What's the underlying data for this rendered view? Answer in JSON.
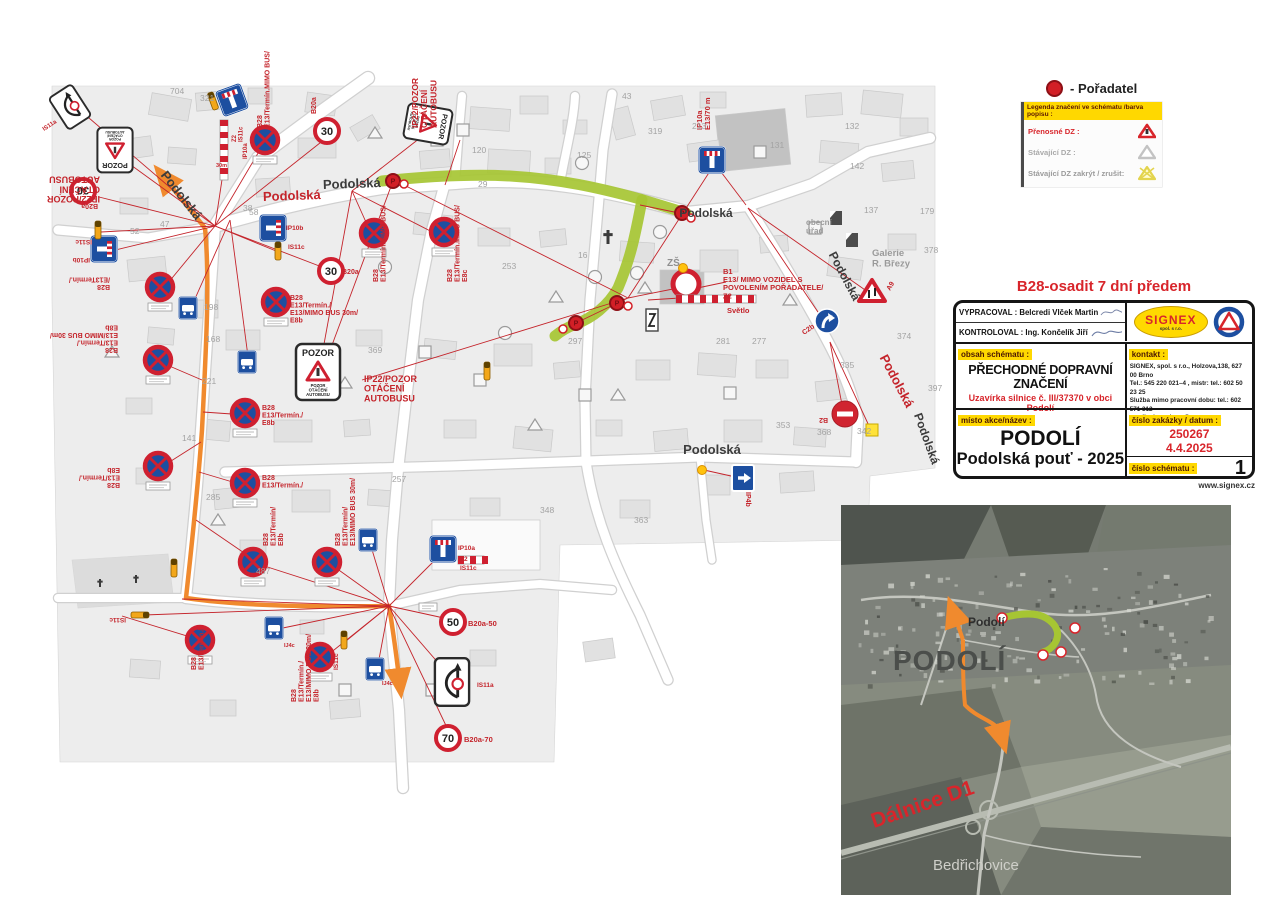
{
  "legend": {
    "poradatel_label": "- Pořadatel",
    "header": "Legenda značení ve schématu /barva popisu :",
    "rows": [
      {
        "label": "Přenosné  DZ :",
        "style": "red"
      },
      {
        "label": "Stávající DZ :",
        "style": "gray"
      },
      {
        "label": "Stávající DZ zakrýt / zrušit:",
        "style": "gray2"
      }
    ]
  },
  "title_block": {
    "heading": "B28-osadit 7 dní předem",
    "vypracoval_label": "VYPRACOVAL",
    "vypracoval_value": ": Belcredi Vlček Martin",
    "kontroloval_label": "KONTROLOVAL",
    "kontroloval_value": ": Ing. Končelík Jiří",
    "logo_text": "SIGNEX",
    "logo_sub": "spol. s r.o.",
    "obsah_label": "obsah schématu :",
    "obsah_title": "PŘECHODNÉ DOPRAVNÍ ZNAČENÍ",
    "obsah_sub": "Uzavírka silnice č. III/37370 v obci Podolí",
    "kontakt_label": "kontakt :",
    "kontakt_lines": [
      "SIGNEX, spol. s r.o., Holzova,138, 627 00 Brno",
      "Tel.: 545 220 021–4 , mistr: tel.: 602 50 23 25",
      "Služba mimo pracovní dobu: tel.: 602 571 312",
      "email: signexbrno@seznam.cz"
    ],
    "misto_label": "místo  akce/název :",
    "misto_line1": "PODOLÍ",
    "misto_line2": "Podolská pouť - 2025",
    "zakazka_label": "číslo zakázky / datum :",
    "zakazka_cislo": "250267",
    "zakazka_datum": "4.4.2025",
    "schema_label": "číslo schématu :",
    "schema_cislo": "1",
    "website": "www.signex.cz"
  },
  "inset": {
    "town_big": "PODOLÍ",
    "town_small": "Podolí",
    "highway": "Dálnice D1",
    "village": "Bedřichovice"
  },
  "colors": {
    "red": "#c4242b",
    "green_route": "#a6c533",
    "orange_route": "#f08a2e",
    "sign_blue": "#1d4fa0",
    "sign_red": "#cf2030",
    "yellow": "#ffd800"
  },
  "map": {
    "street_labels": [
      [
        "Podolská",
        178,
        198,
        52,
        "#3c3c3c",
        13
      ],
      [
        "Podolská",
        292,
        200,
        -2,
        "#c4242b",
        13
      ],
      [
        "Podolská",
        352,
        188,
        -2,
        "#3c3c3c",
        13
      ],
      [
        "Podolská",
        706,
        217,
        0,
        "#3c3c3c",
        12
      ],
      [
        "Podolská",
        841,
        278,
        62,
        "#3c3c3c",
        12
      ],
      [
        "Podolská",
        893,
        383,
        62,
        "#c4242b",
        13
      ],
      [
        "Podolská",
        923,
        440,
        70,
        "#3c3c3c",
        12
      ],
      [
        "Podolská",
        712,
        454,
        0,
        "#3c3c3c",
        13
      ]
    ],
    "gray_labels": [
      [
        "ZŠ",
        667,
        266,
        10,
        "#8f8f8f"
      ],
      [
        "obecní|úřad",
        806,
        225,
        8,
        "#9a9a9a"
      ],
      [
        "Galerie|R. Březy",
        872,
        256,
        9.5,
        "#9a9a9a"
      ]
    ],
    "numbers": [
      [
        "704",
        170,
        94
      ],
      [
        "321",
        200,
        101
      ],
      [
        "43",
        622,
        99
      ],
      [
        "319",
        648,
        134
      ],
      [
        "213",
        692,
        129
      ],
      [
        "120",
        472,
        153
      ],
      [
        "125",
        577,
        158
      ],
      [
        "131",
        770,
        148
      ],
      [
        "132",
        845,
        129
      ],
      [
        "142",
        850,
        169
      ],
      [
        "137",
        864,
        213
      ],
      [
        "179",
        920,
        214
      ],
      [
        "378",
        924,
        253
      ],
      [
        "374",
        897,
        339
      ],
      [
        "397",
        928,
        391
      ],
      [
        "335",
        840,
        368
      ],
      [
        "353",
        776,
        428
      ],
      [
        "368",
        817,
        435
      ],
      [
        "342",
        857,
        434
      ],
      [
        "281",
        716,
        344
      ],
      [
        "277",
        752,
        344
      ],
      [
        "297",
        568,
        344
      ],
      [
        "253",
        502,
        269
      ],
      [
        "369",
        368,
        353
      ],
      [
        "168",
        206,
        342
      ],
      [
        "198",
        204,
        310
      ],
      [
        "221",
        202,
        384
      ],
      [
        "141",
        182,
        441
      ],
      [
        "285",
        206,
        500
      ],
      [
        "47",
        160,
        227
      ],
      [
        "58",
        249,
        215
      ],
      [
        "38",
        243,
        211
      ],
      [
        "16",
        578,
        258
      ],
      [
        "29",
        478,
        187
      ],
      [
        "487",
        256,
        574
      ],
      [
        "348",
        540,
        513
      ],
      [
        "363",
        634,
        523
      ],
      [
        "257",
        392,
        482
      ],
      [
        "52",
        130,
        234
      ]
    ],
    "labels": [
      [
        "IP22/POZOR|OTÁČENÍ|AUTOBUSU",
        100,
        196,
        180,
        9
      ],
      [
        "IP22/POZOR|OTÁČENÍ|AUTOBUSU",
        418,
        128,
        -90,
        8.5
      ],
      [
        "IP22/POZOR|OTÁČENÍ|AUTOBUSU",
        364,
        382,
        0,
        9
      ],
      [
        "B28|E13/Termín.MIMO BUS/",
        262,
        128,
        -90,
        7
      ],
      [
        "B28|E13/Termín.MIMO BUS/",
        378,
        282,
        -90,
        7
      ],
      [
        "B28|E13/Termín.MIMO BUS/|E8c",
        452,
        282,
        -90,
        7
      ],
      [
        "B20a",
        316,
        114,
        -90,
        7
      ],
      [
        "B20a",
        98,
        204,
        180,
        7
      ],
      [
        "B20a",
        342,
        274,
        0,
        7
      ],
      [
        "B20a-50",
        468,
        626,
        0,
        7.5
      ],
      [
        "B20a-70",
        464,
        742,
        0,
        7.5
      ],
      [
        "IS11c",
        92,
        240,
        180,
        6.5
      ],
      [
        "IP10b",
        90,
        258,
        180,
        6.5
      ],
      [
        "IP10b",
        286,
        230,
        0,
        6.5
      ],
      [
        "IS11c",
        288,
        249,
        0,
        6.5
      ],
      [
        "IS11c",
        126,
        618,
        180,
        6.5
      ],
      [
        "IS11c",
        338,
        670,
        -90,
        6.5
      ],
      [
        "IP10a",
        458,
        550,
        0,
        6.5
      ],
      [
        "Z2",
        460,
        561,
        0,
        6.5
      ],
      [
        "IS11c",
        460,
        570,
        0,
        6.5
      ],
      [
        "IP10a|E13/70 m",
        702,
        130,
        -90,
        7.5
      ],
      [
        "B1|E13/  MIMO VOZIDEL S|POVOLENÍM POŘADATELE/|Z2",
        723,
        274,
        0,
        7.5
      ],
      [
        "Světlo",
        727,
        313,
        0,
        7.5
      ],
      [
        "C2b",
        804,
        335,
        -35,
        7
      ],
      [
        "B2",
        828,
        418,
        180,
        7
      ],
      [
        "IP4b",
        746,
        492,
        90,
        7
      ],
      [
        "A9",
        890,
        291,
        -60,
        7
      ],
      [
        "IS11a",
        44,
        131,
        -33,
        6
      ],
      [
        "IS11a",
        477,
        687,
        0,
        6.5
      ],
      [
        "B28|E13/Termín./|E13/MIMO BUS 30m/|E8b",
        118,
        348,
        180,
        7
      ],
      [
        "B28|/E13Termín./",
        110,
        285,
        180,
        7
      ],
      [
        "B28|E13/Termín./|E8b",
        120,
        483,
        180,
        7
      ],
      [
        "B28|E13/Termín./|E13/MIMO BUS 30m/|E8b",
        290,
        300,
        0,
        7
      ],
      [
        "B28|E13/Termín./|E8b",
        262,
        410,
        0,
        7
      ],
      [
        "B28|E13/Termín./",
        262,
        480,
        0,
        7
      ],
      [
        "B28|E13/Termín./",
        196,
        670,
        -90,
        7
      ],
      [
        "B28|E13/Termín/|E8b",
        268,
        546,
        -90,
        7
      ],
      [
        "B28|E13/Termín/|E13/MIMO BUS 30m/",
        340,
        546,
        -90,
        7
      ],
      [
        "B28|E13/Termín./|E13/MIMO BUS 30m/|E8b",
        296,
        702,
        -90,
        7
      ],
      [
        "IJ4c",
        284,
        647,
        0,
        5.5
      ],
      [
        "IJ4c",
        382,
        685,
        0,
        5.5
      ],
      [
        "Z2|IS11c",
        236,
        142,
        -90,
        6
      ],
      [
        "IP10a",
        247,
        159,
        -90,
        6
      ],
      [
        "30m",
        216,
        167,
        0,
        5.5
      ]
    ],
    "red_lines": [
      [
        215,
        226,
        82,
        112
      ],
      [
        215,
        226,
        124,
        160
      ],
      [
        215,
        226,
        101,
        232
      ],
      [
        215,
        226,
        107,
        252
      ],
      [
        215,
        226,
        163,
        289
      ],
      [
        215,
        226,
        264,
        143
      ],
      [
        215,
        226,
        228,
        140
      ],
      [
        215,
        226,
        281,
        253
      ],
      [
        215,
        226,
        330,
        135
      ],
      [
        215,
        226,
        335,
        272
      ],
      [
        215,
        226,
        99,
        197
      ],
      [
        230,
        220,
        190,
        310
      ],
      [
        230,
        220,
        249,
        364
      ],
      [
        352,
        191,
        374,
        240
      ],
      [
        352,
        191,
        446,
        239
      ],
      [
        352,
        191,
        420,
        138
      ],
      [
        352,
        191,
        320,
        366
      ],
      [
        393,
        181,
        322,
        372
      ],
      [
        628,
        298,
        712,
        168
      ],
      [
        628,
        298,
        688,
        286
      ],
      [
        628,
        298,
        578,
        322
      ],
      [
        628,
        298,
        406,
        186
      ],
      [
        628,
        298,
        362,
        380
      ],
      [
        640,
        205,
        684,
        214
      ],
      [
        688,
        290,
        726,
        282
      ],
      [
        648,
        300,
        680,
        298
      ],
      [
        748,
        208,
        868,
        292
      ],
      [
        748,
        208,
        826,
        324
      ],
      [
        830,
        342,
        843,
        410
      ],
      [
        830,
        342,
        870,
        428
      ],
      [
        704,
        470,
        740,
        478
      ],
      [
        712,
        160,
        746,
        205
      ],
      [
        389,
        606,
        255,
        563
      ],
      [
        389,
        606,
        329,
        563
      ],
      [
        389,
        606,
        278,
        629
      ],
      [
        389,
        606,
        324,
        658
      ],
      [
        389,
        606,
        370,
        543
      ],
      [
        389,
        606,
        443,
        552
      ],
      [
        389,
        606,
        453,
        620
      ],
      [
        389,
        606,
        450,
        734
      ],
      [
        389,
        606,
        453,
        680
      ],
      [
        389,
        606,
        182,
        599
      ],
      [
        389,
        606,
        144,
        615
      ],
      [
        200,
        640,
        122,
        616
      ],
      [
        389,
        606,
        377,
        670
      ],
      [
        389,
        606,
        346,
        641
      ],
      [
        202,
        380,
        160,
        362
      ],
      [
        203,
        412,
        246,
        415
      ],
      [
        201,
        442,
        160,
        468
      ],
      [
        199,
        472,
        246,
        486
      ],
      [
        196,
        520,
        253,
        559
      ],
      [
        445,
        185,
        460,
        140
      ]
    ],
    "signs": [
      [
        "b28",
        265,
        140
      ],
      [
        "b28",
        374,
        233
      ],
      [
        "b28",
        444,
        232
      ],
      [
        "b28",
        160,
        287
      ],
      [
        "b28",
        276,
        302
      ],
      [
        "b28",
        158,
        360
      ],
      [
        "b28",
        245,
        413
      ],
      [
        "b28",
        158,
        466
      ],
      [
        "b28",
        245,
        483
      ],
      [
        "b28",
        253,
        562
      ],
      [
        "b28",
        327,
        562
      ],
      [
        "b28",
        320,
        657
      ],
      [
        "b28",
        200,
        640
      ],
      [
        "speed",
        327,
        131,
        "30"
      ],
      [
        "speed",
        331,
        271,
        "30"
      ],
      [
        "speed",
        83,
        191,
        "30",
        180
      ],
      [
        "speed",
        453,
        622,
        "50"
      ],
      [
        "speed",
        448,
        738,
        "70"
      ],
      [
        "pozor",
        115,
        150,
        180,
        0.8
      ],
      [
        "pozor",
        428,
        124,
        100,
        0.8
      ],
      [
        "pozor",
        318,
        372,
        0,
        1
      ],
      [
        "is11abox",
        70,
        107,
        -33,
        0.75
      ],
      [
        "is11abox",
        452,
        682,
        0,
        0.95
      ],
      [
        "ip10a",
        232,
        100,
        -20
      ],
      [
        "ip10a",
        712,
        160,
        0
      ],
      [
        "ip10a",
        443,
        549,
        0
      ],
      [
        "ip10b",
        104,
        249
      ],
      [
        "ip10b",
        273,
        228
      ],
      [
        "busstop",
        188,
        308
      ],
      [
        "busstop",
        247,
        362
      ],
      [
        "busstop",
        368,
        540
      ],
      [
        "busstop",
        274,
        628
      ],
      [
        "busstop",
        375,
        669
      ],
      [
        "b1",
        686,
        284
      ],
      [
        "b2",
        845,
        414
      ],
      [
        "c2b",
        827,
        321
      ],
      [
        "ip4b",
        743,
        478
      ],
      [
        "a9",
        872,
        292
      ],
      [
        "z2h",
        716,
        299,
        80
      ],
      [
        "z2h",
        471,
        560,
        26
      ],
      [
        "z2v",
        224,
        150,
        60
      ],
      [
        "marker",
        98,
        230,
        0
      ],
      [
        "marker",
        213,
        101,
        -20
      ],
      [
        "marker",
        278,
        251,
        0
      ],
      [
        "marker",
        344,
        640,
        0
      ],
      [
        "marker",
        140,
        615,
        90
      ],
      [
        "marker",
        174,
        568,
        0
      ],
      [
        "marker",
        487,
        371,
        0
      ],
      [
        "cross",
        608,
        237,
        14
      ],
      [
        "cross",
        100,
        583,
        8
      ],
      [
        "cross",
        136,
        579,
        8
      ],
      [
        "ysq",
        872,
        430
      ],
      [
        "ydot",
        702,
        470
      ],
      [
        "ydot",
        683,
        268
      ],
      [
        "plate",
        428,
        603
      ],
      [
        "redp",
        393,
        181
      ],
      [
        "redp",
        682,
        213
      ],
      [
        "redp",
        617,
        303
      ],
      [
        "redp",
        576,
        323
      ],
      [
        "wdot",
        404,
        184
      ],
      [
        "wdot",
        691,
        218
      ],
      [
        "wdot",
        628,
        306
      ],
      [
        "wdot",
        563,
        329
      ]
    ],
    "gray_signs": [
      [
        "t",
        375,
        133
      ],
      [
        "s",
        437,
        140
      ],
      [
        "s",
        463,
        130
      ],
      [
        "t",
        345,
        383
      ],
      [
        "s",
        425,
        352
      ],
      [
        "c",
        505,
        333
      ],
      [
        "c",
        595,
        277
      ],
      [
        "c",
        637,
        273
      ],
      [
        "t",
        645,
        288
      ],
      [
        "z",
        652,
        320
      ],
      [
        "t",
        556,
        297
      ],
      [
        "s",
        480,
        380
      ],
      [
        "s",
        585,
        395
      ],
      [
        "t",
        618,
        395
      ],
      [
        "c",
        660,
        232
      ],
      [
        "s",
        760,
        152
      ],
      [
        "t",
        790,
        300
      ],
      [
        "s",
        815,
        228
      ],
      [
        "sh",
        836,
        218
      ],
      [
        "sh",
        852,
        240
      ],
      [
        "s",
        730,
        393
      ],
      [
        "t",
        218,
        520
      ],
      [
        "s",
        345,
        690
      ],
      [
        "s",
        432,
        690
      ],
      [
        "c",
        385,
        267
      ],
      [
        "t",
        112,
        352
      ],
      [
        "t",
        535,
        425
      ],
      [
        "c",
        582,
        163
      ]
    ]
  }
}
